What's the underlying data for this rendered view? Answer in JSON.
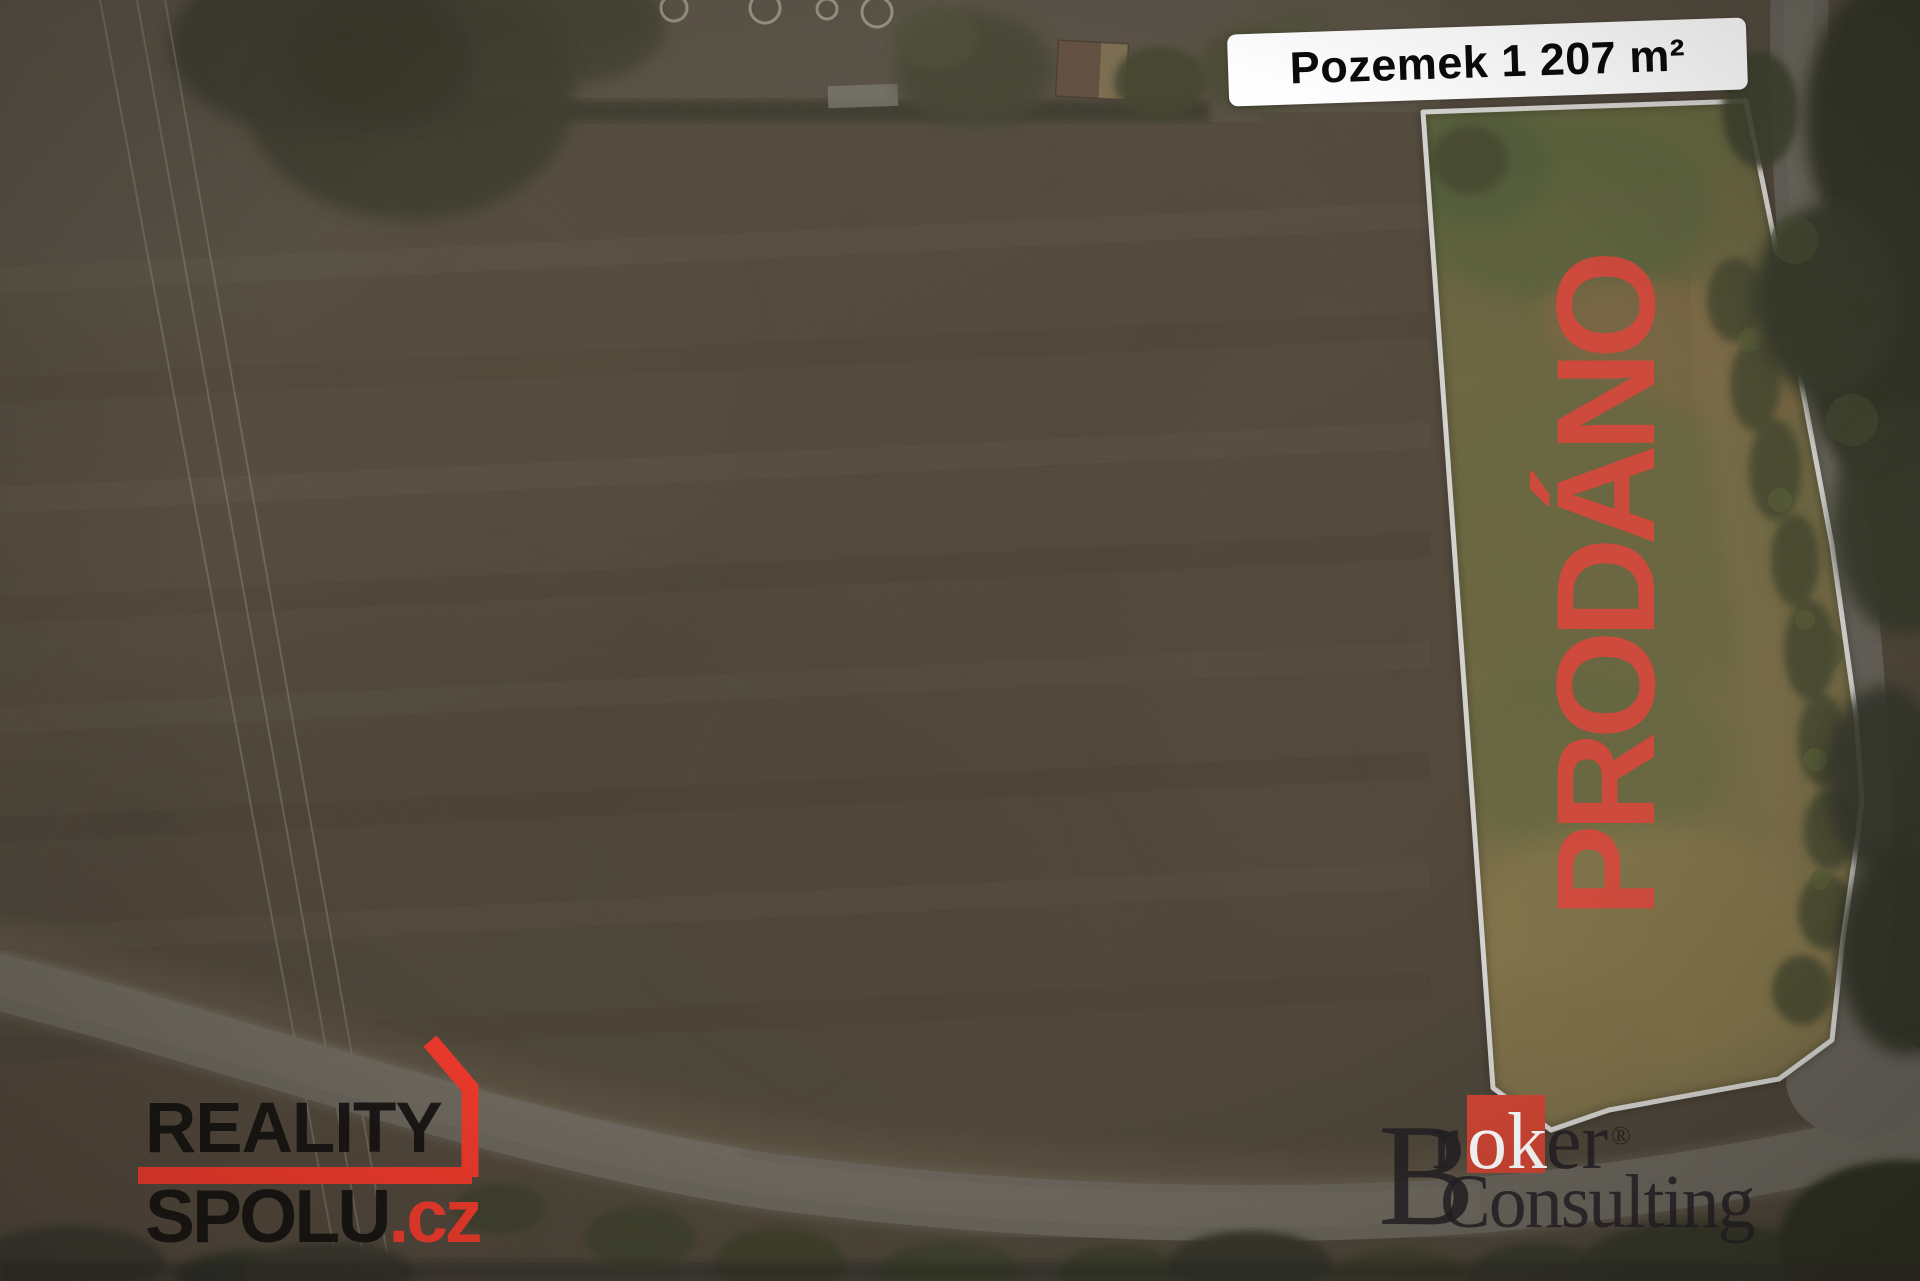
{
  "photo": {
    "area_label": "Pozemek 1 207 m²",
    "sold_watermark": "PRODÁNO",
    "colors": {
      "watermark_red": "#d8473c",
      "boundary_white": "#ffffff",
      "field_dark": "#55493c",
      "plot_grass": "#7d7448",
      "road_grey": "#716d64"
    }
  },
  "branding": {
    "reality_spolu": {
      "word1": "REALITY",
      "word2": "SPOLU",
      "tld": ".cz",
      "accent_red": "#ee3a2c"
    },
    "broker_consulting": {
      "drop_cap": "B",
      "part1": "r",
      "highlight": "ok",
      "part2": "er",
      "registered_mark": "®",
      "word2": "Consulting",
      "accent_red": "#cf4534"
    }
  }
}
